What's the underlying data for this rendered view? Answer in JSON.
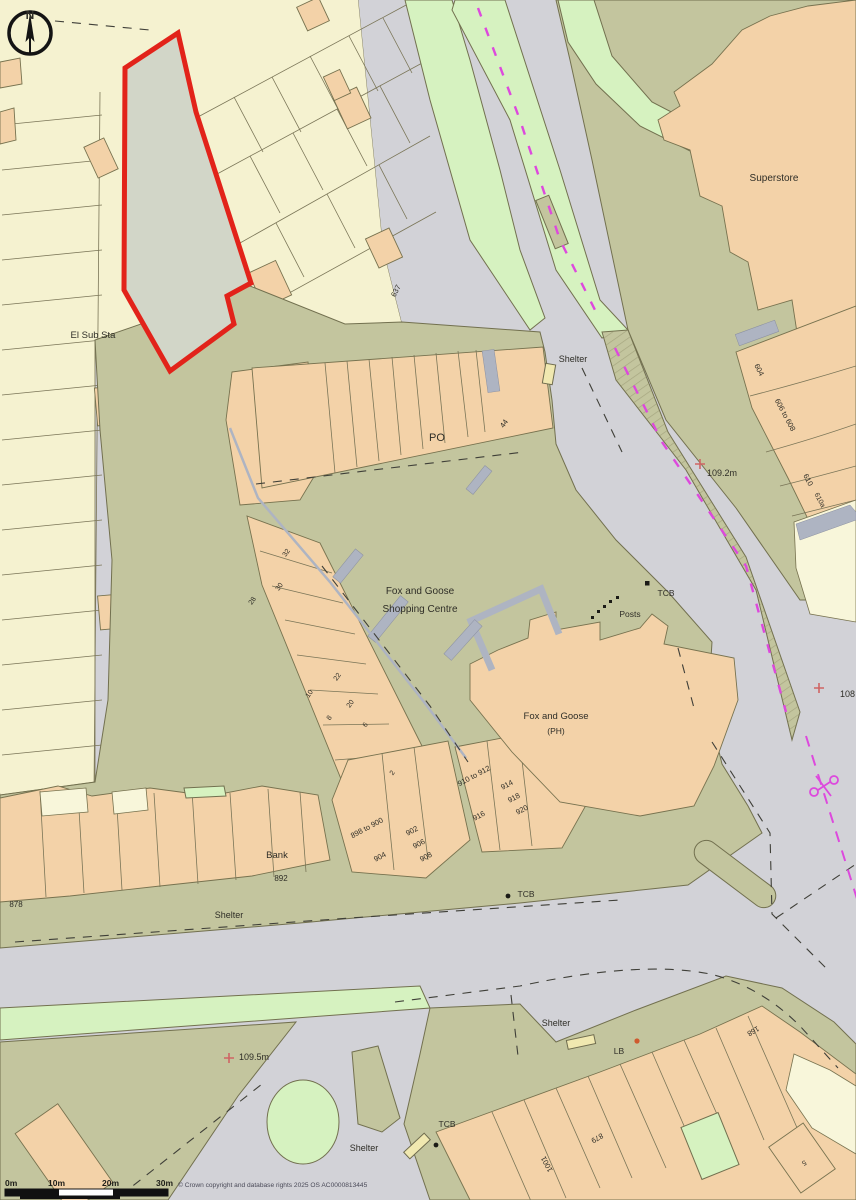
{
  "map": {
    "compass": {
      "letter": "N"
    },
    "labels": {
      "el_sub_sta": "El Sub Sta",
      "superstore": "Superstore",
      "shelter_top": "Shelter",
      "po": "PO",
      "fg_centre_line1": "Fox and Goose",
      "fg_centre_line2": "Shopping Centre",
      "fg_ph_line1": "Fox and Goose",
      "fg_ph_line2": "(PH)",
      "bank": "Bank",
      "posts": "Posts",
      "tcb_east": "TCB",
      "tcb_south": "TCB",
      "tcb_west": "TCB",
      "lb": "LB",
      "shelter_mid": "Shelter",
      "shelter_bottom_center": "Shelter",
      "shelter_bottom_left": "Shelter"
    },
    "house_numbers": {
      "n637": "637",
      "n604": "604",
      "n606_608": "606 to 608",
      "n610": "610",
      "n610a": "610a",
      "n44": "44",
      "n32": "32",
      "n30": "30",
      "n28": "28",
      "n22": "22",
      "n20": "20",
      "n10": "10",
      "n8": "8",
      "n6": "6",
      "n2": "2",
      "n898_900": "898 to 900",
      "n902": "902",
      "n904": "904",
      "n906": "906",
      "n908": "908",
      "n910_912": "910 to 912",
      "n914": "914",
      "n916": "916",
      "n918": "918",
      "n920": "920",
      "n892": "892",
      "n878": "878",
      "n168": "168",
      "n879": "879",
      "n1001": "1001",
      "n5": "5"
    },
    "spot_heights": {
      "h_109_2": "109.2m",
      "h_108": "108",
      "h_109_5": "109.5m"
    },
    "scale_bar": {
      "ticks": [
        "0m",
        "10m",
        "20m",
        "30m"
      ]
    },
    "copyright": "© Crown copyright and database rights 2025 OS AC0000813445",
    "colors": {
      "site_boundary": "#e2231a",
      "building": "#f3d2a8",
      "terrace": "#f5f2d0",
      "road": "#d2d2d7",
      "pavement": "#c3c59e",
      "grass": "#d6f2c0",
      "canopy": "#aeb4c2",
      "boundary_magenta": "#dd49dd"
    }
  }
}
